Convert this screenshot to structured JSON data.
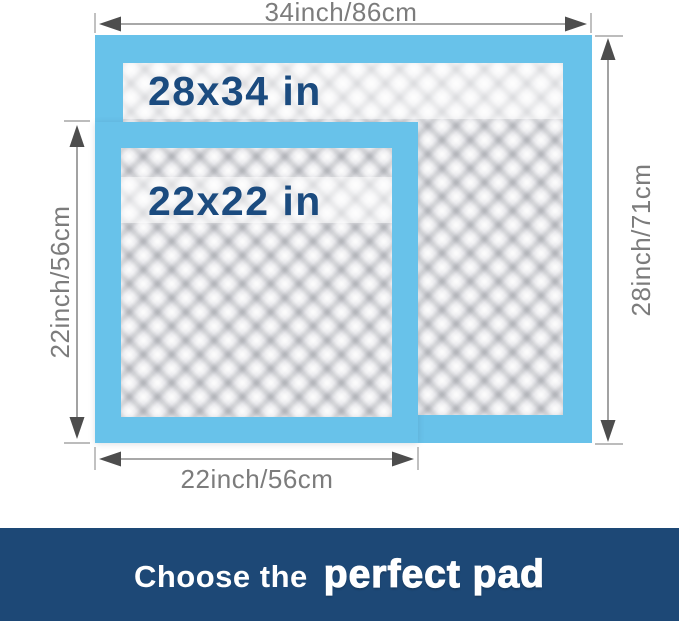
{
  "pads": {
    "large": {
      "size_label": "28x34 in"
    },
    "small": {
      "size_label": "22x22 in"
    }
  },
  "dimensions": {
    "top_width": "34inch/86cm",
    "right_height": "28inch/71cm",
    "left_height": "22inch/56cm",
    "bottom_width": "22inch/56cm"
  },
  "banner": {
    "text_regular": "Choose the",
    "text_bold": "perfect pad"
  },
  "colors": {
    "pad_border": "#68C2EA",
    "pad_label": "#1B4B7F",
    "dimension_text": "#7C7C7C",
    "dimension_line": "#8B8B8B",
    "arrowhead": "#4D4D4D",
    "banner_bg": "#1D4876",
    "banner_text": "#FFFFFF"
  }
}
